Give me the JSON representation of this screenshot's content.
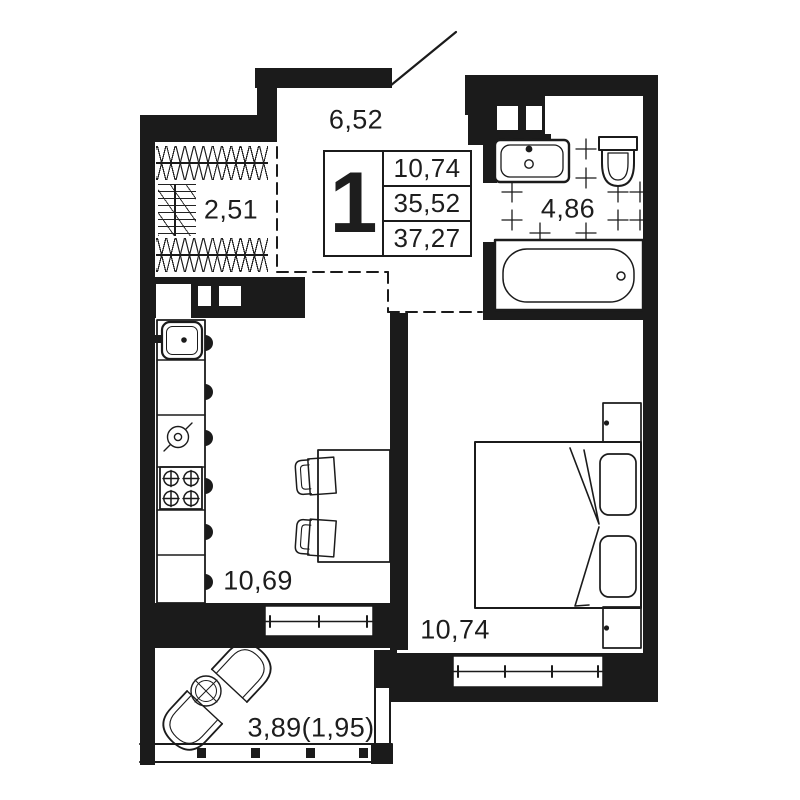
{
  "unit_info": {
    "rooms_count": "1",
    "living_area": "10,74",
    "area_without_balcony": "35,52",
    "total_area": "37,27"
  },
  "room_labels": {
    "hallway": "6,52",
    "wardrobe": "2,51",
    "bathroom": "4,86",
    "kitchen_living": "10,69",
    "bedroom": "10,74",
    "balcony": "3,89(1,95)"
  },
  "colors": {
    "wall": "#1b1b1b",
    "background": "#ffffff"
  }
}
